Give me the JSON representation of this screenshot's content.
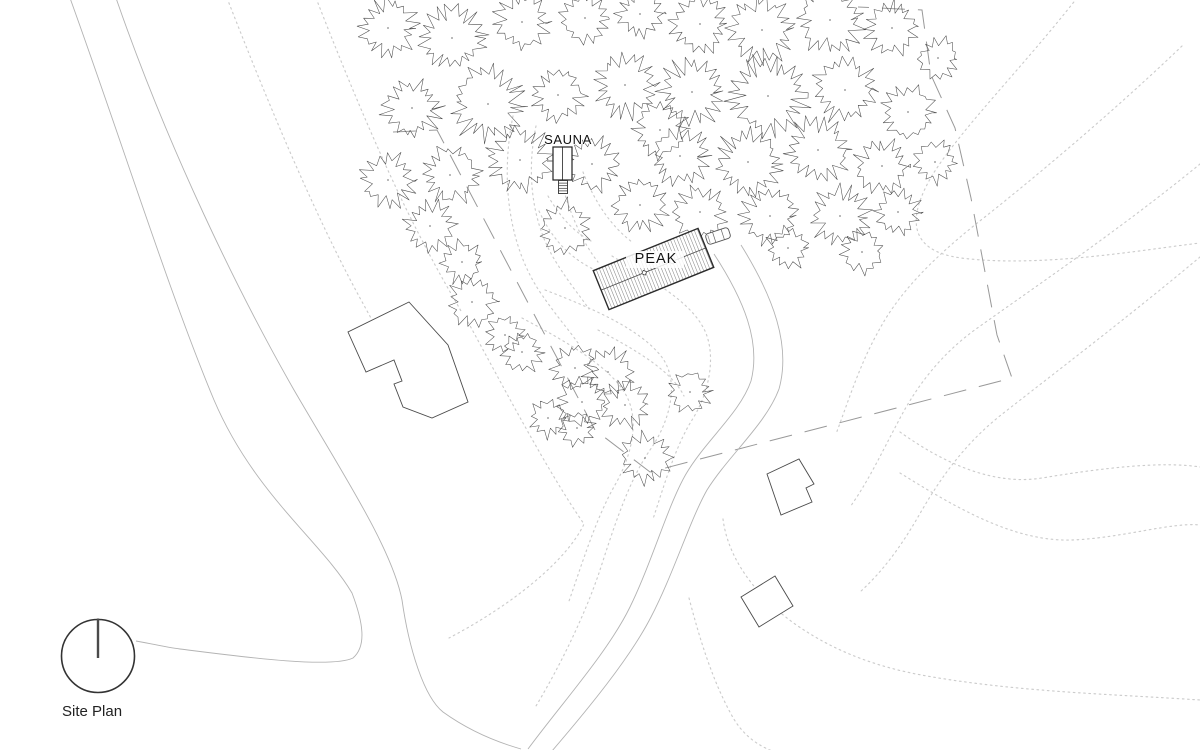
{
  "page": {
    "width": 1200,
    "height": 750,
    "background": "#ffffff"
  },
  "labels": {
    "sauna": "SAUNA",
    "peak": "PEAK",
    "title": "Site Plan"
  },
  "colors": {
    "contour": "#cccccc",
    "road": "#b3b3b3",
    "boundary": "#999999",
    "building_outline": "#4a4a4a",
    "peak_outline": "#2b2b2b",
    "hatch": "#8a8a8a",
    "tree": "#4d4d4d",
    "tree_dot": "#888888",
    "text": "#111111",
    "north": "#333333"
  },
  "north_arrow": {
    "cx": 98,
    "cy": 656,
    "r": 36.5,
    "needle_top": 618.5,
    "needle_bottom": 658
  },
  "peak_house": {
    "cx": 653.5,
    "cy": 269,
    "width": 113,
    "height": 42,
    "angle": -22,
    "hatch_step": 3.2,
    "ridge_markers": [
      -10,
      20
    ]
  },
  "sauna_building": {
    "x": 553,
    "y": 147,
    "w": 19,
    "h": 33,
    "ladder": {
      "x": 558.5,
      "y": 180.5,
      "w": 9,
      "h": 13,
      "rungs": 4
    },
    "tick_y": 161
  },
  "car": {
    "cx": 718,
    "cy": 236,
    "w": 24,
    "h": 11,
    "angle": -18
  },
  "buildings": [
    {
      "name": "neighbor-house-west",
      "points": "409,302 348,332 366,372 394,360 402,381 394,384 403,407 432,418 468,402 448,345"
    },
    {
      "name": "shed-northeast",
      "points": "767,474 799,459 814,484 806,488 812,502 781,515"
    },
    {
      "name": "shed-south",
      "points": "775,576 793,606 759,627 741,597"
    }
  ],
  "boundary": {
    "points": "393,132 437,130 595,430 650,472 1012,378 997,335 985,272 971,198 955,128 931,75 922,10 858,7",
    "dash": "23 13"
  },
  "roads": [
    "M 70,-2 C 122,142 170,295 214,400 C 254,494 322,542 352,593 C 363,622 367,646 353,658 C 330,669 236,656 180,649 C 164,647 148,643 136,641",
    "M 116,-2 C 168,148 238,292 294,390 C 341,471 392,548 402,600 C 409,649 424,697 443,712 C 468,730 493,741 521,749",
    "M 714,254 C 744,300 761,342 751,381 C 740,413 706,440 686,474 C 668,505 652,562 630,607 C 608,652 562,703 528,749",
    "M 741,245 C 774,298 791,346 779,389 C 766,424 729,455 707,490 C 690,520 673,575 651,617 C 630,658 588,709 552,751"
  ],
  "contours": [
    "M 227,-2 C 266,98 314,214 360,298 C 389,351 407,384 421,407",
    "M 316,-2 C 351,88 389,178 424,244 C 441,277 452,295 461,311",
    "M 536,126 C 526,174 532,224 556,262 C 569,283 580,296 589,309",
    "M 513,116 C 500,180 509,246 540,292 C 557,317 569,330 578,343",
    "M 560,176 C 568,210 582,242 598,262",
    "M 583,172 C 595,203 612,227 632,242",
    "M 548,196 C 561,218 574,232 591,241",
    "M 539,211 C 553,241 571,258 593,269",
    "M 545,290 C 600,311 641,331 661,356 C 680,380 671,420 650,450 C 628,482 613,530 600,570 C 585,615 560,666 536,706",
    "M 522,318 C 571,344 611,368 626,395 C 640,420 632,455 615,485 C 596,518 582,564 568,604",
    "M 612,256 C 651,280 691,301 705,331 C 717,358 708,395 692,420 C 675,447 663,489 653,519",
    "M 598,330 C 640,352 672,372 684,396",
    "M 468,322 C 505,390 548,472 584,524 C 566,562 510,606 449,638",
    "M 1077,-2 C 1022,68 962,128 933,174 C 906,219 909,251 961,258 C 1041,268 1141,250 1200,243",
    "M 1182,46 C 1112,113 1032,180 976,224 C 930,261 898,294 878,332 C 860,364 848,402 836,434",
    "M 1200,164 C 1122,228 1032,289 976,329 C 940,355 916,387 898,422 C 882,452 868,482 850,507",
    "M 1200,257 C 1132,314 1052,375 1001,415 C 962,446 938,482 918,517 C 900,548 882,572 860,592",
    "M 900,432 C 942,462 992,486 1042,478 C 1102,468 1162,461 1200,467",
    "M 900,473 C 952,505 1012,542 1072,540 C 1122,538 1172,522 1200,525",
    "M 723,519 C 728,559 756,596 795,624 C 835,652 876,666 916,674 C 1011,692 1111,694 1200,700",
    "M 689,598 C 700,640 712,679 731,714 C 741,733 755,744 772,751"
  ],
  "trees": [
    [
      388,
      28,
      30
    ],
    [
      452,
      38,
      34
    ],
    [
      522,
      22,
      28
    ],
    [
      585,
      18,
      26
    ],
    [
      640,
      14,
      24
    ],
    [
      700,
      24,
      30
    ],
    [
      762,
      30,
      34
    ],
    [
      830,
      20,
      34
    ],
    [
      892,
      28,
      28
    ],
    [
      938,
      58,
      22
    ],
    [
      412,
      108,
      30
    ],
    [
      488,
      104,
      38
    ],
    [
      558,
      95,
      28
    ],
    [
      625,
      85,
      33
    ],
    [
      692,
      92,
      34
    ],
    [
      768,
      96,
      40
    ],
    [
      845,
      90,
      33
    ],
    [
      908,
      112,
      28
    ],
    [
      660,
      130,
      28
    ],
    [
      388,
      180,
      28
    ],
    [
      450,
      175,
      30
    ],
    [
      520,
      160,
      34
    ],
    [
      592,
      164,
      28
    ],
    [
      680,
      156,
      30
    ],
    [
      748,
      162,
      34
    ],
    [
      818,
      150,
      33
    ],
    [
      882,
      166,
      28
    ],
    [
      935,
      162,
      22
    ],
    [
      430,
      226,
      26
    ],
    [
      565,
      228,
      28
    ],
    [
      640,
      205,
      28
    ],
    [
      700,
      212,
      28
    ],
    [
      770,
      216,
      30
    ],
    [
      840,
      216,
      30
    ],
    [
      898,
      212,
      24
    ],
    [
      862,
      252,
      22
    ],
    [
      788,
      248,
      22
    ],
    [
      462,
      262,
      22
    ],
    [
      472,
      302,
      26
    ],
    [
      505,
      335,
      20
    ],
    [
      522,
      352,
      22
    ],
    [
      575,
      368,
      24
    ],
    [
      608,
      372,
      26
    ],
    [
      582,
      402,
      26
    ],
    [
      625,
      405,
      24
    ],
    [
      548,
      418,
      20
    ],
    [
      577,
      428,
      18
    ],
    [
      690,
      392,
      22
    ],
    [
      645,
      458,
      26
    ]
  ]
}
